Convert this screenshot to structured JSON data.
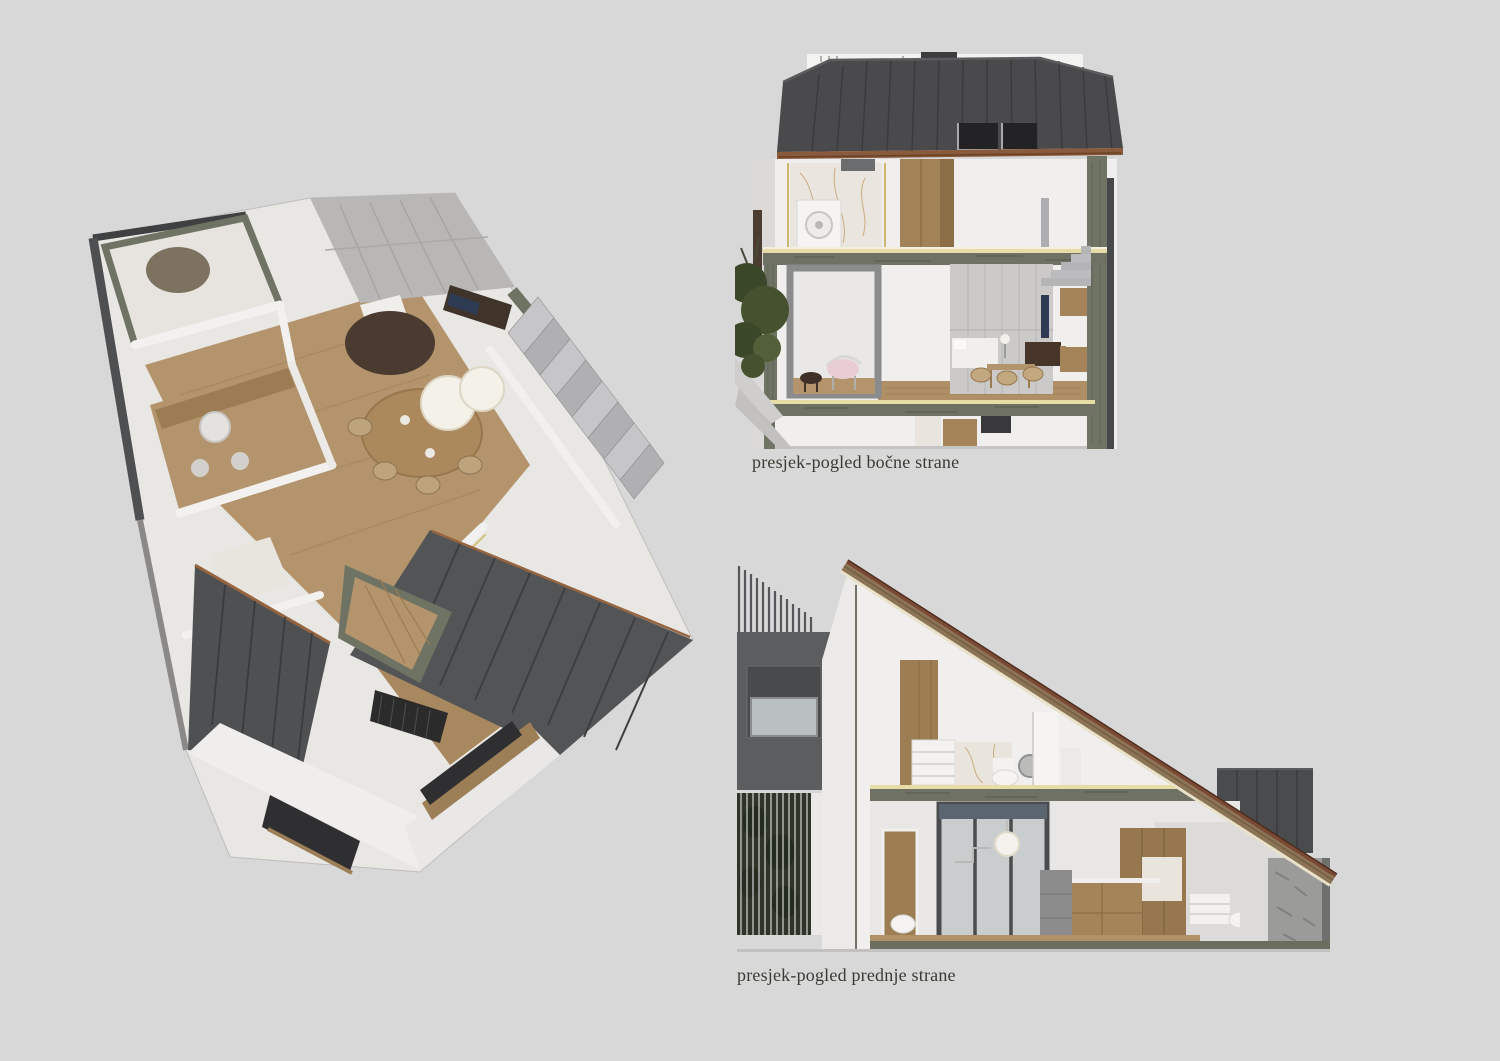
{
  "page": {
    "background_color": "#d8d8d8",
    "width": 1500,
    "height": 1061
  },
  "captions": {
    "side_section": "presjek-pogled bočne strane",
    "front_section": "presjek-pogled prednje strane"
  },
  "palette": {
    "background": "#d8d8d8",
    "roof_dark_gray": "#4a4a4c",
    "roof_seam": "#3a3a3c",
    "skylight": "#232325",
    "copper_fascia": "#8a5a3c",
    "wall_white": "#f0efed",
    "wall_shadow": "#c9c8c6",
    "wood_floor": "#b3946c",
    "wood_cabinet": "#9d7e52",
    "marble_green": "#6e7363",
    "stair_carpet": "#b5b5b7",
    "panel_gray": "#5c5d5f",
    "tree_green": "#45522f",
    "chair_pink": "#e8cdd2",
    "tv_navy": "#2e3b52",
    "glass_gray": "#bac0c1",
    "gold_trim": "#cdb66d",
    "rug_brown": "#4a3a30"
  }
}
